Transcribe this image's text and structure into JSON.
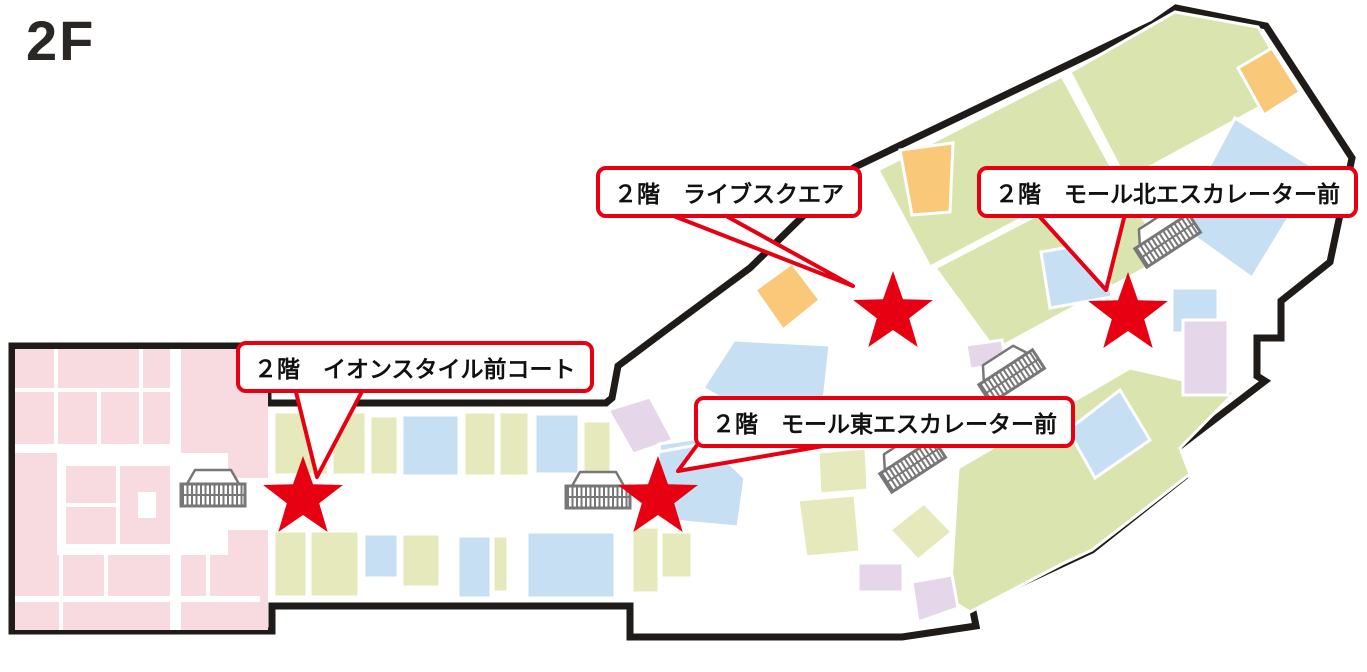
{
  "page": {
    "title": "2F"
  },
  "callouts": [
    {
      "id": "live-square",
      "label": "２階　ライブスクエア"
    },
    {
      "id": "mall-north-escalator",
      "label": "２階　モール北エスカレーター前"
    },
    {
      "id": "aeon-style-court",
      "label": "２階　イオンスタイル前コート"
    },
    {
      "id": "mall-east-escalator",
      "label": "２階　モール東エスカレーター前"
    }
  ],
  "markers": [
    {
      "location": "ライブスクエア"
    },
    {
      "location": "モール北エスカレーター前"
    },
    {
      "location": "イオンスタイル前コート"
    },
    {
      "location": "モール東エスカレーター前"
    }
  ],
  "colors": {
    "red": "#e60012",
    "outline": "#1f1b18",
    "pink": "#f8dbe0",
    "green_large": "#d9e4af",
    "green_small": "#e6e9bc",
    "blue": "#c7dff2",
    "orange": "#f9c979",
    "lavender": "#e6d6e9",
    "icon_gray": "#777777",
    "text": "#111111"
  }
}
